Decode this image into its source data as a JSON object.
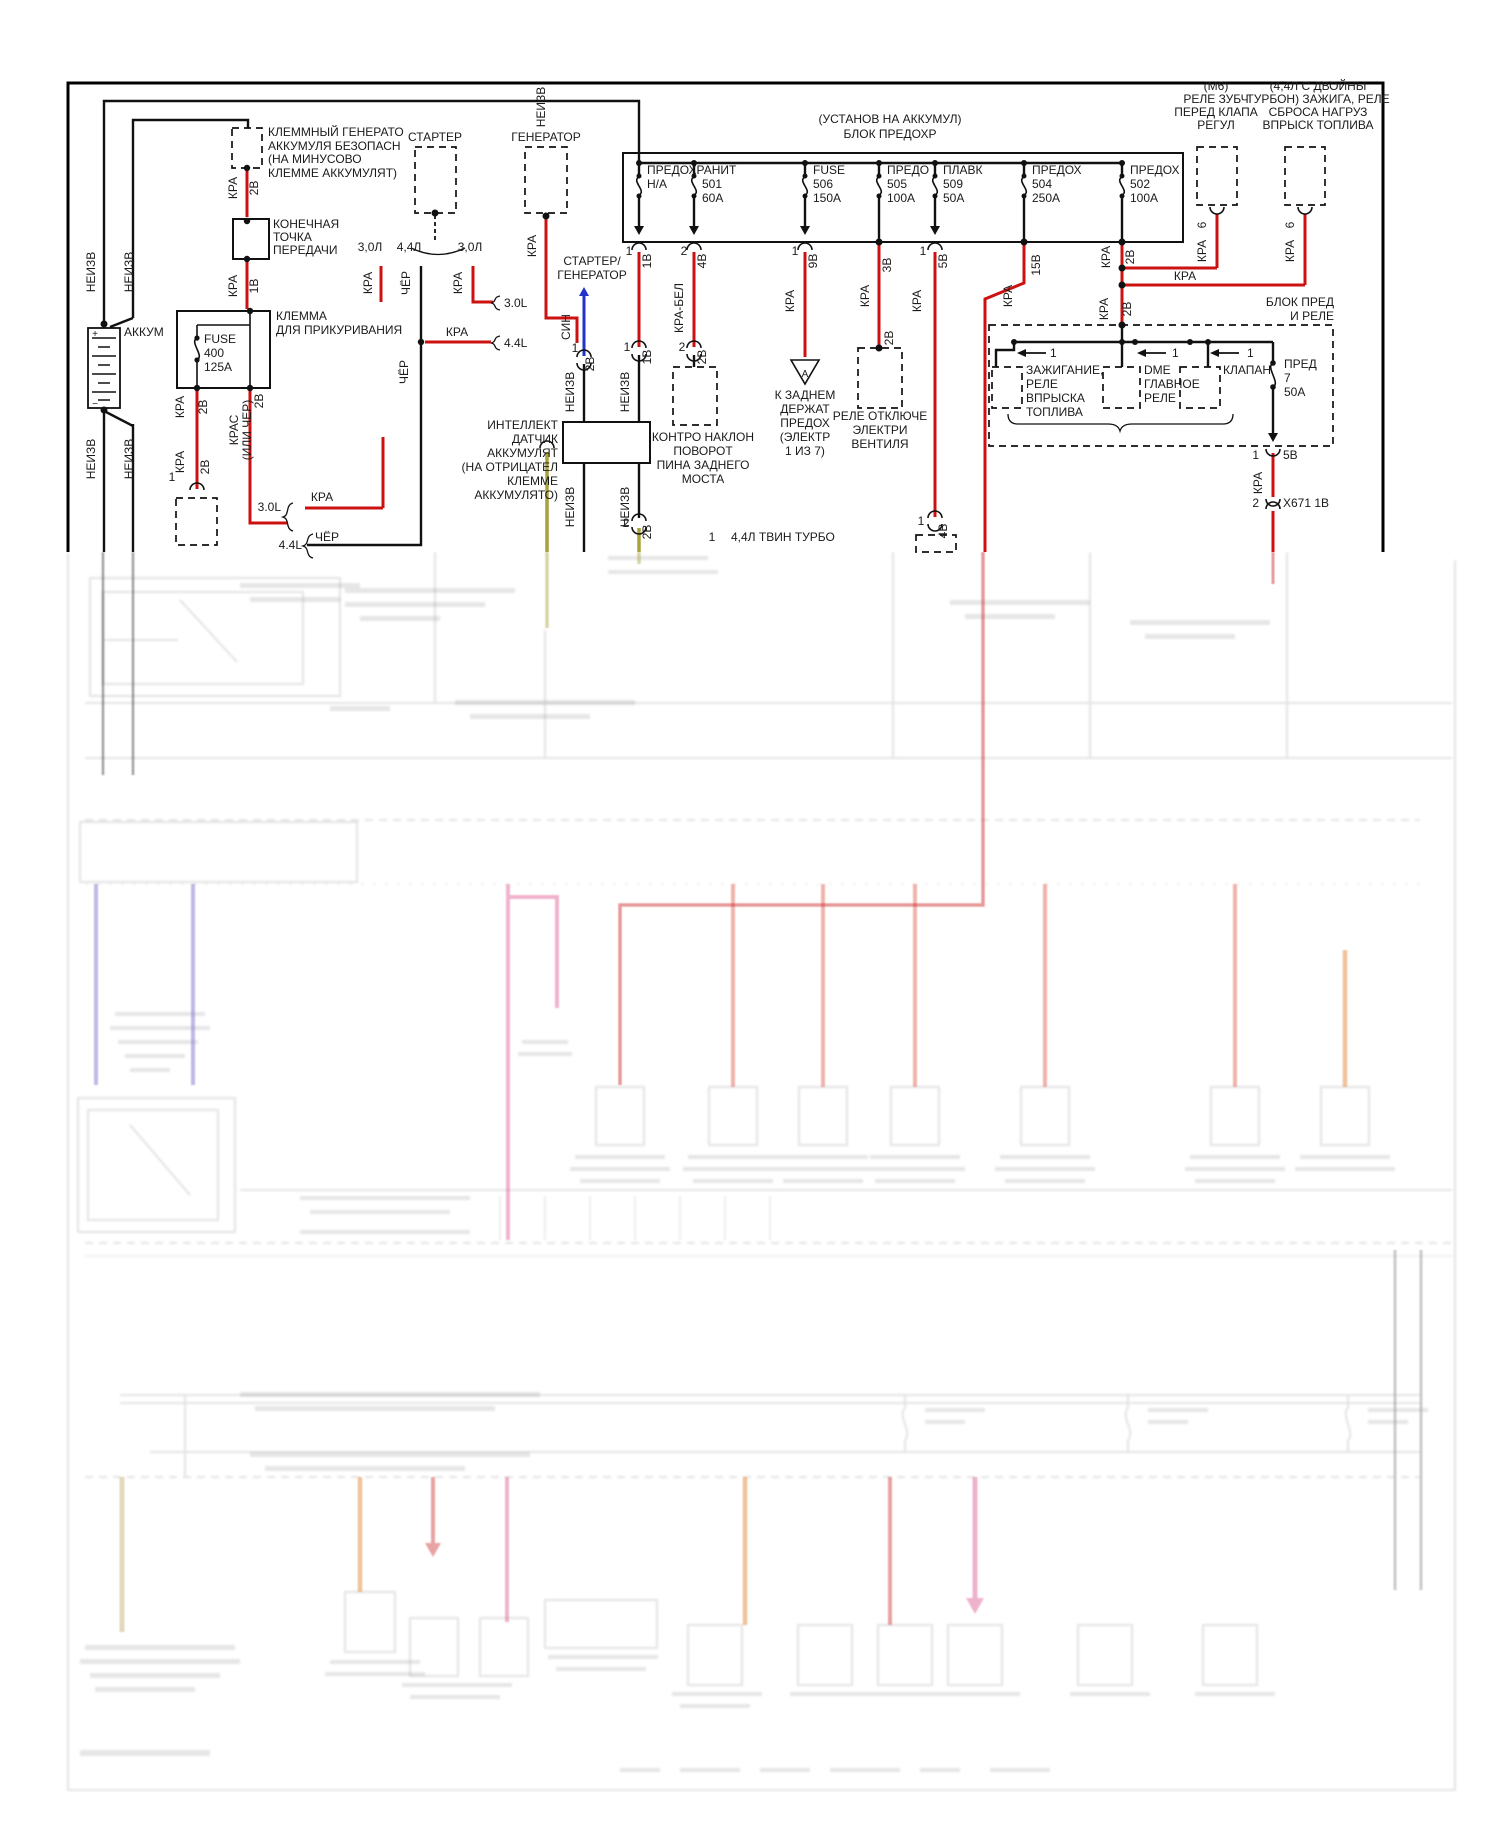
{
  "diagram": {
    "title_note": "Wiring diagram, power distribution (Russian), crisp inset over faded page",
    "colors": {
      "wire_power_red": "#cc1111",
      "wire_ground_black": "#111111",
      "wire_signal_blue": "#2233cc",
      "wire_olive": "#a8a23c",
      "faded_violet": "#8273cc",
      "faded_pink": "#e0689a",
      "faded_salmon": "#e0685a",
      "faded_orange": "#e08838",
      "faded_tan": "#c9b27b"
    },
    "texts": [
      {
        "n": "note-term-gen-1",
        "t": "КЛЕММНЫЙ ГЕНЕРАТО",
        "x": 268,
        "y": 136
      },
      {
        "n": "note-term-gen-2",
        "t": "АККУМУЛЯ БЕЗОПАСН",
        "x": 268,
        "y": 150
      },
      {
        "n": "note-term-gen-3",
        "t": "(НА МИНУСОВО",
        "x": 268,
        "y": 163
      },
      {
        "n": "note-term-gen-4",
        "t": "КЛЕММЕ АККУМУЛЯТ)",
        "x": 268,
        "y": 177
      },
      {
        "n": "starter",
        "t": "СТАРТЕР",
        "x": 435,
        "y": 141,
        "a": "m"
      },
      {
        "n": "generator",
        "t": "ГЕНЕРАТОР",
        "x": 546,
        "y": 141,
        "a": "m"
      },
      {
        "n": "endpoint-1",
        "t": "КОНЕЧНАЯ",
        "x": 273,
        "y": 228
      },
      {
        "n": "endpoint-2",
        "t": "ТОЧКА",
        "x": 273,
        "y": 241
      },
      {
        "n": "endpoint-3",
        "t": "ПЕРЕДАЧИ",
        "x": 273,
        "y": 254
      },
      {
        "n": "cig-clamp-1",
        "t": "КЛЕММА",
        "x": 276,
        "y": 320
      },
      {
        "n": "cig-clamp-2",
        "t": "ДЛЯ ПРИКУРИВАНИЯ",
        "x": 276,
        "y": 334
      },
      {
        "n": "battery-label",
        "t": "АККУМ",
        "x": 124,
        "y": 336
      },
      {
        "n": "fuse400-1",
        "t": "FUSE",
        "x": 204,
        "y": 343
      },
      {
        "n": "fuse400-2",
        "t": "400",
        "x": 204,
        "y": 357
      },
      {
        "n": "fuse400-3",
        "t": "125A",
        "x": 204,
        "y": 371
      },
      {
        "n": "fusebox-header-1",
        "t": "(УСТАНОВ НА АККУМУЛ)",
        "x": 890,
        "y": 123,
        "a": "m"
      },
      {
        "n": "fusebox-header-2",
        "t": "БЛОК ПРЕДОХР",
        "x": 890,
        "y": 138,
        "a": "m"
      },
      {
        "n": "fuse1-name",
        "t": "ПРЕДОХРАНИТ",
        "x": 647,
        "y": 174
      },
      {
        "n": "fuse1-val",
        "t": "Н/А",
        "x": 647,
        "y": 188
      },
      {
        "n": "fuse2-num",
        "t": "501",
        "x": 702,
        "y": 188
      },
      {
        "n": "fuse2-amp",
        "t": "60A",
        "x": 702,
        "y": 202
      },
      {
        "n": "fuse3-name",
        "t": "FUSE",
        "x": 813,
        "y": 174
      },
      {
        "n": "fuse3-num",
        "t": "506",
        "x": 813,
        "y": 188
      },
      {
        "n": "fuse3-amp",
        "t": "150A",
        "x": 813,
        "y": 202
      },
      {
        "n": "fuse4-name",
        "t": "ПРЕДО",
        "x": 887,
        "y": 174
      },
      {
        "n": "fuse4-num",
        "t": "505",
        "x": 887,
        "y": 188
      },
      {
        "n": "fuse4-amp",
        "t": "100A",
        "x": 887,
        "y": 202
      },
      {
        "n": "fuse5-name",
        "t": "ПЛАВК",
        "x": 943,
        "y": 174
      },
      {
        "n": "fuse5-num",
        "t": "509",
        "x": 943,
        "y": 188
      },
      {
        "n": "fuse5-amp",
        "t": "50A",
        "x": 943,
        "y": 202
      },
      {
        "n": "fuse6-name",
        "t": "ПРЕДОХ",
        "x": 1032,
        "y": 174
      },
      {
        "n": "fuse6-num",
        "t": "504",
        "x": 1032,
        "y": 188
      },
      {
        "n": "fuse6-amp",
        "t": "250A",
        "x": 1032,
        "y": 202
      },
      {
        "n": "fuse7-name",
        "t": "ПРЕДОХ",
        "x": 1130,
        "y": 174
      },
      {
        "n": "fuse7-num",
        "t": "502",
        "x": 1130,
        "y": 188
      },
      {
        "n": "fuse7-amp",
        "t": "100A",
        "x": 1130,
        "y": 202
      },
      {
        "n": "m6-relay-1",
        "t": "(М6)",
        "x": 1216,
        "y": 90,
        "a": "m"
      },
      {
        "n": "m6-relay-2",
        "t": "РЕЛЕ ЗУБЧ",
        "x": 1216,
        "y": 103,
        "a": "m"
      },
      {
        "n": "m6-relay-3",
        "t": "ПЕРЕД КЛАПА",
        "x": 1216,
        "y": 116,
        "a": "m"
      },
      {
        "n": "m6-relay-4",
        "t": "РЕГУЛ",
        "x": 1216,
        "y": 129,
        "a": "m"
      },
      {
        "n": "tt-relay-1",
        "t": "(4,4Л С ДВОЙНЫ",
        "x": 1318,
        "y": 90,
        "a": "m"
      },
      {
        "n": "tt-relay-2",
        "t": "ТУРБОН) ЗАЖИГА, РЕЛЕ",
        "x": 1318,
        "y": 103,
        "a": "m"
      },
      {
        "n": "tt-relay-3",
        "t": "СБРОСА НАГРУЗ",
        "x": 1318,
        "y": 116,
        "a": "m"
      },
      {
        "n": "tt-relay-4",
        "t": "ВПРЫСК ТОПЛИВА",
        "x": 1318,
        "y": 129,
        "a": "m"
      },
      {
        "n": "block-pred-1",
        "t": "БЛОК ПРЕД",
        "x": 1334,
        "y": 306,
        "a": "e"
      },
      {
        "n": "block-pred-2",
        "t": "И РЕЛЕ",
        "x": 1334,
        "y": 320,
        "a": "e"
      },
      {
        "n": "relayA-1",
        "t": "ЗАЖИГАНИЕ,",
        "x": 1026,
        "y": 374
      },
      {
        "n": "relayA-2",
        "t": "РЕЛЕ",
        "x": 1026,
        "y": 388
      },
      {
        "n": "relayA-3",
        "t": "ВПРЫСКА",
        "x": 1026,
        "y": 402
      },
      {
        "n": "relayA-4",
        "t": "ТОПЛИВА",
        "x": 1026,
        "y": 416
      },
      {
        "n": "relayB-1",
        "t": "DME",
        "x": 1144,
        "y": 374
      },
      {
        "n": "relayB-2",
        "t": "ГЛАВНОЕ",
        "x": 1144,
        "y": 388
      },
      {
        "n": "relayB-3",
        "t": "РЕЛЕ",
        "x": 1144,
        "y": 402
      },
      {
        "n": "relayC",
        "t": "КЛАПАН",
        "x": 1223,
        "y": 374
      },
      {
        "n": "relayA-pin",
        "t": "1",
        "x": 1050,
        "y": 357
      },
      {
        "n": "relayB-pin",
        "t": "1",
        "x": 1172,
        "y": 357
      },
      {
        "n": "relayC-pin",
        "t": "1",
        "x": 1247,
        "y": 357
      },
      {
        "n": "pred7-1",
        "t": "ПРЕД",
        "x": 1284,
        "y": 368
      },
      {
        "n": "pred7-2",
        "t": "7",
        "x": 1284,
        "y": 382
      },
      {
        "n": "pred7-3",
        "t": "50А",
        "x": 1284,
        "y": 396
      },
      {
        "n": "pred7-pin",
        "t": "1",
        "x": 1259,
        "y": 459,
        "a": "e"
      },
      {
        "n": "pred7-net",
        "t": "5В",
        "x": 1283,
        "y": 459
      },
      {
        "n": "x671-pin",
        "t": "2",
        "x": 1259,
        "y": 507,
        "a": "e"
      },
      {
        "n": "x671-net",
        "t": "X671 1В",
        "x": 1283,
        "y": 507
      },
      {
        "n": "relay-otkl-1",
        "t": "РЕЛЕ ОТКЛЮЧЕ",
        "x": 880,
        "y": 420,
        "a": "m"
      },
      {
        "n": "relay-otkl-2",
        "t": "ЭЛЕКТРИ",
        "x": 880,
        "y": 434,
        "a": "m"
      },
      {
        "n": "relay-otkl-3",
        "t": "ВЕНТИЛЯ",
        "x": 880,
        "y": 448,
        "a": "m"
      },
      {
        "n": "kzadnem-1",
        "t": "К ЗАДНЕМ",
        "x": 805,
        "y": 399,
        "a": "m"
      },
      {
        "n": "kzadnem-2",
        "t": "ДЕРЖАТ",
        "x": 805,
        "y": 413,
        "a": "m"
      },
      {
        "n": "kzadnem-3",
        "t": "ПРЕДОХ",
        "x": 805,
        "y": 427,
        "a": "m"
      },
      {
        "n": "kzadnem-4",
        "t": "(ЭЛЕКТР",
        "x": 805,
        "y": 441,
        "a": "m"
      },
      {
        "n": "kzadnem-5",
        "t": "1 ИЗ 7)",
        "x": 805,
        "y": 455,
        "a": "m"
      },
      {
        "n": "kontro-1",
        "t": "КОНТРО НАКЛОН",
        "x": 703,
        "y": 441,
        "a": "m"
      },
      {
        "n": "kontro-2",
        "t": "ПОВОРОТ",
        "x": 703,
        "y": 455,
        "a": "m"
      },
      {
        "n": "kontro-3",
        "t": "ПИНА ЗАДНЕГО",
        "x": 703,
        "y": 469,
        "a": "m"
      },
      {
        "n": "kontro-4",
        "t": "МОСТА",
        "x": 703,
        "y": 483,
        "a": "m"
      },
      {
        "n": "intel-1",
        "t": "ИНТЕЛЛЕКТ",
        "x": 558,
        "y": 429,
        "a": "e"
      },
      {
        "n": "intel-2",
        "t": "ДАТЧИК",
        "x": 558,
        "y": 443,
        "a": "e"
      },
      {
        "n": "intel-3",
        "t": "АККУМУЛЯТ",
        "x": 558,
        "y": 457,
        "a": "e"
      },
      {
        "n": "intel-4",
        "t": "(НА ОТРИЦАТЕЛ",
        "x": 558,
        "y": 471,
        "a": "e"
      },
      {
        "n": "intel-5",
        "t": "КЛЕММЕ",
        "x": 558,
        "y": 485,
        "a": "e"
      },
      {
        "n": "intel-6",
        "t": "АККУМУЛЯТО)",
        "x": 558,
        "y": 499,
        "a": "e"
      },
      {
        "n": "legend-num",
        "t": "1",
        "x": 712,
        "y": 541,
        "a": "m"
      },
      {
        "n": "legend-text",
        "t": "4,4Л ТВИН ТУРБО",
        "x": 731,
        "y": 541
      },
      {
        "n": "startgen-1",
        "t": "СТАРТЕР/",
        "x": 592,
        "y": 265,
        "a": "m"
      },
      {
        "n": "startgen-2",
        "t": "ГЕНЕРАТОР",
        "x": 592,
        "y": 279,
        "a": "m"
      },
      {
        "n": "eng-30a",
        "t": "3,0Л",
        "x": 370,
        "y": 251,
        "a": "m"
      },
      {
        "n": "eng-44",
        "t": "4,4Л",
        "x": 409,
        "y": 251,
        "a": "m"
      },
      {
        "n": "eng-30b",
        "t": "3,0Л",
        "x": 470,
        "y": 251,
        "a": "m"
      },
      {
        "n": "eng-30L1",
        "t": "3.0L",
        "x": 504,
        "y": 307
      },
      {
        "n": "kra-mid",
        "t": "КРА",
        "x": 457,
        "y": 336,
        "a": "m"
      },
      {
        "n": "eng-44L1",
        "t": "4.4L",
        "x": 504,
        "y": 347
      },
      {
        "n": "eng-30L2",
        "t": "3.0L",
        "x": 281,
        "y": 511,
        "a": "e"
      },
      {
        "n": "kra-low",
        "t": "КРА",
        "x": 322,
        "y": 501,
        "a": "m"
      },
      {
        "n": "eng-44L2",
        "t": "4.4L",
        "x": 302,
        "y": 549,
        "a": "e"
      },
      {
        "n": "cher-low",
        "t": "ЧЁР",
        "x": 327,
        "y": 541,
        "a": "m"
      },
      {
        "n": "triangle-a",
        "t": "А",
        "x": 805,
        "y": 377,
        "a": "m",
        "s": 10
      },
      {
        "n": "neizv-1",
        "t": "НЕИЗВ",
        "x": 95,
        "y": 272,
        "r": 1
      },
      {
        "n": "neizv-2",
        "t": "НЕИЗВ",
        "x": 133,
        "y": 272,
        "r": 1
      },
      {
        "n": "neizv-3",
        "t": "НЕИЗВ",
        "x": 95,
        "y": 459,
        "r": 1
      },
      {
        "n": "neizv-4",
        "t": "НЕИЗВ",
        "x": 133,
        "y": 459,
        "r": 1
      },
      {
        "n": "neizv-5",
        "t": "НЕИЗВ",
        "x": 545,
        "y": 107,
        "r": 1
      },
      {
        "n": "kra-1",
        "t": "КРА",
        "x": 237,
        "y": 188,
        "r": 1
      },
      {
        "n": "net-2v-1",
        "t": "2В",
        "x": 258,
        "y": 188,
        "r": 1
      },
      {
        "n": "kra-2",
        "t": "КРА",
        "x": 237,
        "y": 286,
        "r": 1
      },
      {
        "n": "net-1v-1",
        "t": "1В",
        "x": 258,
        "y": 286,
        "r": 1
      },
      {
        "n": "kra-3",
        "t": "КРА",
        "x": 184,
        "y": 407,
        "r": 1
      },
      {
        "n": "net-2v-2",
        "t": "2В",
        "x": 207,
        "y": 407,
        "r": 1
      },
      {
        "n": "kra-4",
        "t": "КРА",
        "x": 184,
        "y": 462,
        "r": 1
      },
      {
        "n": "net-2v-3",
        "t": "2В",
        "x": 209,
        "y": 467,
        "r": 1
      },
      {
        "n": "pin-1a",
        "t": "1",
        "x": 172,
        "y": 481,
        "a": "m"
      },
      {
        "n": "kras",
        "t": "КРАС",
        "x": 238,
        "y": 430,
        "r": 1
      },
      {
        "n": "ili-cher",
        "t": "(ИЛИ ЧЕР)",
        "x": 251,
        "y": 430,
        "r": 1
      },
      {
        "n": "net-2v-4",
        "t": "2В",
        "x": 263,
        "y": 401,
        "r": 1
      },
      {
        "n": "kra-5",
        "t": "КРА",
        "x": 372,
        "y": 283,
        "r": 1
      },
      {
        "n": "cher-1",
        "t": "ЧЁР",
        "x": 410,
        "y": 283,
        "r": 1
      },
      {
        "n": "kra-6",
        "t": "КРА",
        "x": 462,
        "y": 283,
        "r": 1
      },
      {
        "n": "kra-gen",
        "t": "КРА",
        "x": 536,
        "y": 246,
        "r": 1
      },
      {
        "n": "cher-2",
        "t": "ЧЁР",
        "x": 408,
        "y": 372,
        "r": 1
      },
      {
        "n": "sin",
        "t": "СИН",
        "x": 570,
        "y": 327,
        "r": 1
      },
      {
        "n": "pin-sin",
        "t": "1",
        "x": 575,
        "y": 352,
        "a": "m"
      },
      {
        "n": "net-2v-5",
        "t": "2В",
        "x": 594,
        "y": 364,
        "r": 1
      },
      {
        "n": "f1-pin",
        "t": "1",
        "x": 629,
        "y": 255,
        "a": "m"
      },
      {
        "n": "f1-net",
        "t": "1В",
        "x": 651,
        "y": 261,
        "r": 1
      },
      {
        "n": "f1-pin2",
        "t": "1",
        "x": 627,
        "y": 351,
        "a": "m"
      },
      {
        "n": "f1-net2",
        "t": "1В",
        "x": 651,
        "y": 357,
        "r": 1
      },
      {
        "n": "f2-pin",
        "t": "2",
        "x": 684,
        "y": 255,
        "a": "m"
      },
      {
        "n": "f2-net",
        "t": "4В",
        "x": 706,
        "y": 261,
        "r": 1
      },
      {
        "n": "kra-bel",
        "t": "КРА-БЕЛ",
        "x": 683,
        "y": 308,
        "r": 1
      },
      {
        "n": "f2-pin2",
        "t": "2",
        "x": 682,
        "y": 351,
        "a": "m"
      },
      {
        "n": "f2-net2",
        "t": "2В",
        "x": 706,
        "y": 357,
        "r": 1
      },
      {
        "n": "f3-pin",
        "t": "1",
        "x": 795,
        "y": 255,
        "a": "m"
      },
      {
        "n": "f3-net",
        "t": "9В",
        "x": 817,
        "y": 261,
        "r": 1
      },
      {
        "n": "f3-kra",
        "t": "КРА",
        "x": 794,
        "y": 301,
        "r": 1
      },
      {
        "n": "f4-net",
        "t": "3В",
        "x": 891,
        "y": 265,
        "r": 1
      },
      {
        "n": "f4-kra",
        "t": "КРА",
        "x": 869,
        "y": 296,
        "r": 1
      },
      {
        "n": "f4-net2",
        "t": "2В",
        "x": 893,
        "y": 338,
        "r": 1
      },
      {
        "n": "f5-pin",
        "t": "1",
        "x": 923,
        "y": 255,
        "a": "m"
      },
      {
        "n": "f5-net",
        "t": "5В",
        "x": 947,
        "y": 261,
        "r": 1
      },
      {
        "n": "f5-kra",
        "t": "КРА",
        "x": 921,
        "y": 301,
        "r": 1
      },
      {
        "n": "f5-pin2",
        "t": "1",
        "x": 921,
        "y": 525,
        "a": "m"
      },
      {
        "n": "f5-net2",
        "t": "4В",
        "x": 947,
        "y": 531,
        "r": 1
      },
      {
        "n": "f6-net",
        "t": "15В",
        "x": 1040,
        "y": 265,
        "r": 1
      },
      {
        "n": "f6-kra",
        "t": "КРА",
        "x": 1012,
        "y": 296,
        "r": 1
      },
      {
        "n": "f7-kra",
        "t": "КРА",
        "x": 1110,
        "y": 257,
        "r": 1
      },
      {
        "n": "f7-net",
        "t": "2В",
        "x": 1134,
        "y": 257,
        "r": 1
      },
      {
        "n": "f7-kra2",
        "t": "КРА",
        "x": 1108,
        "y": 309,
        "r": 1
      },
      {
        "n": "f7-net2",
        "t": "2В",
        "x": 1131,
        "y": 309,
        "r": 1
      },
      {
        "n": "kra-horiz",
        "t": "КРА",
        "x": 1185,
        "y": 280,
        "a": "m"
      },
      {
        "n": "regul-pin",
        "t": "6",
        "x": 1206,
        "y": 225,
        "r": 1
      },
      {
        "n": "regul-kra",
        "t": "КРА",
        "x": 1206,
        "y": 251,
        "r": 1
      },
      {
        "n": "vprysk-pin",
        "t": "6",
        "x": 1294,
        "y": 225,
        "r": 1
      },
      {
        "n": "vprysk-kra",
        "t": "КРА",
        "x": 1294,
        "y": 251,
        "r": 1
      },
      {
        "n": "pred7-kra",
        "t": "КРА",
        "x": 1262,
        "y": 483,
        "r": 1
      },
      {
        "n": "neizv-int-1",
        "t": "НЕИЗВ",
        "x": 574,
        "y": 392,
        "r": 1
      },
      {
        "n": "neizv-int-2",
        "t": "НЕИЗВ",
        "x": 629,
        "y": 392,
        "r": 1
      },
      {
        "n": "neizv-int-3",
        "t": "НЕИЗВ",
        "x": 574,
        "y": 507,
        "r": 1
      },
      {
        "n": "neizv-int-4",
        "t": "НЕИЗВ",
        "x": 629,
        "y": 507,
        "r": 1
      },
      {
        "n": "lowbump-pin",
        "t": "2",
        "x": 626,
        "y": 527,
        "a": "m"
      },
      {
        "n": "lowbump-net",
        "t": "2В",
        "x": 651,
        "y": 532,
        "r": 1
      },
      {
        "n": "battery-plus",
        "t": "+",
        "x": 95,
        "y": 337,
        "a": "m",
        "s": 10
      },
      {
        "n": "battery-minus",
        "t": "−",
        "x": 95,
        "y": 407,
        "a": "m",
        "s": 10
      }
    ]
  }
}
